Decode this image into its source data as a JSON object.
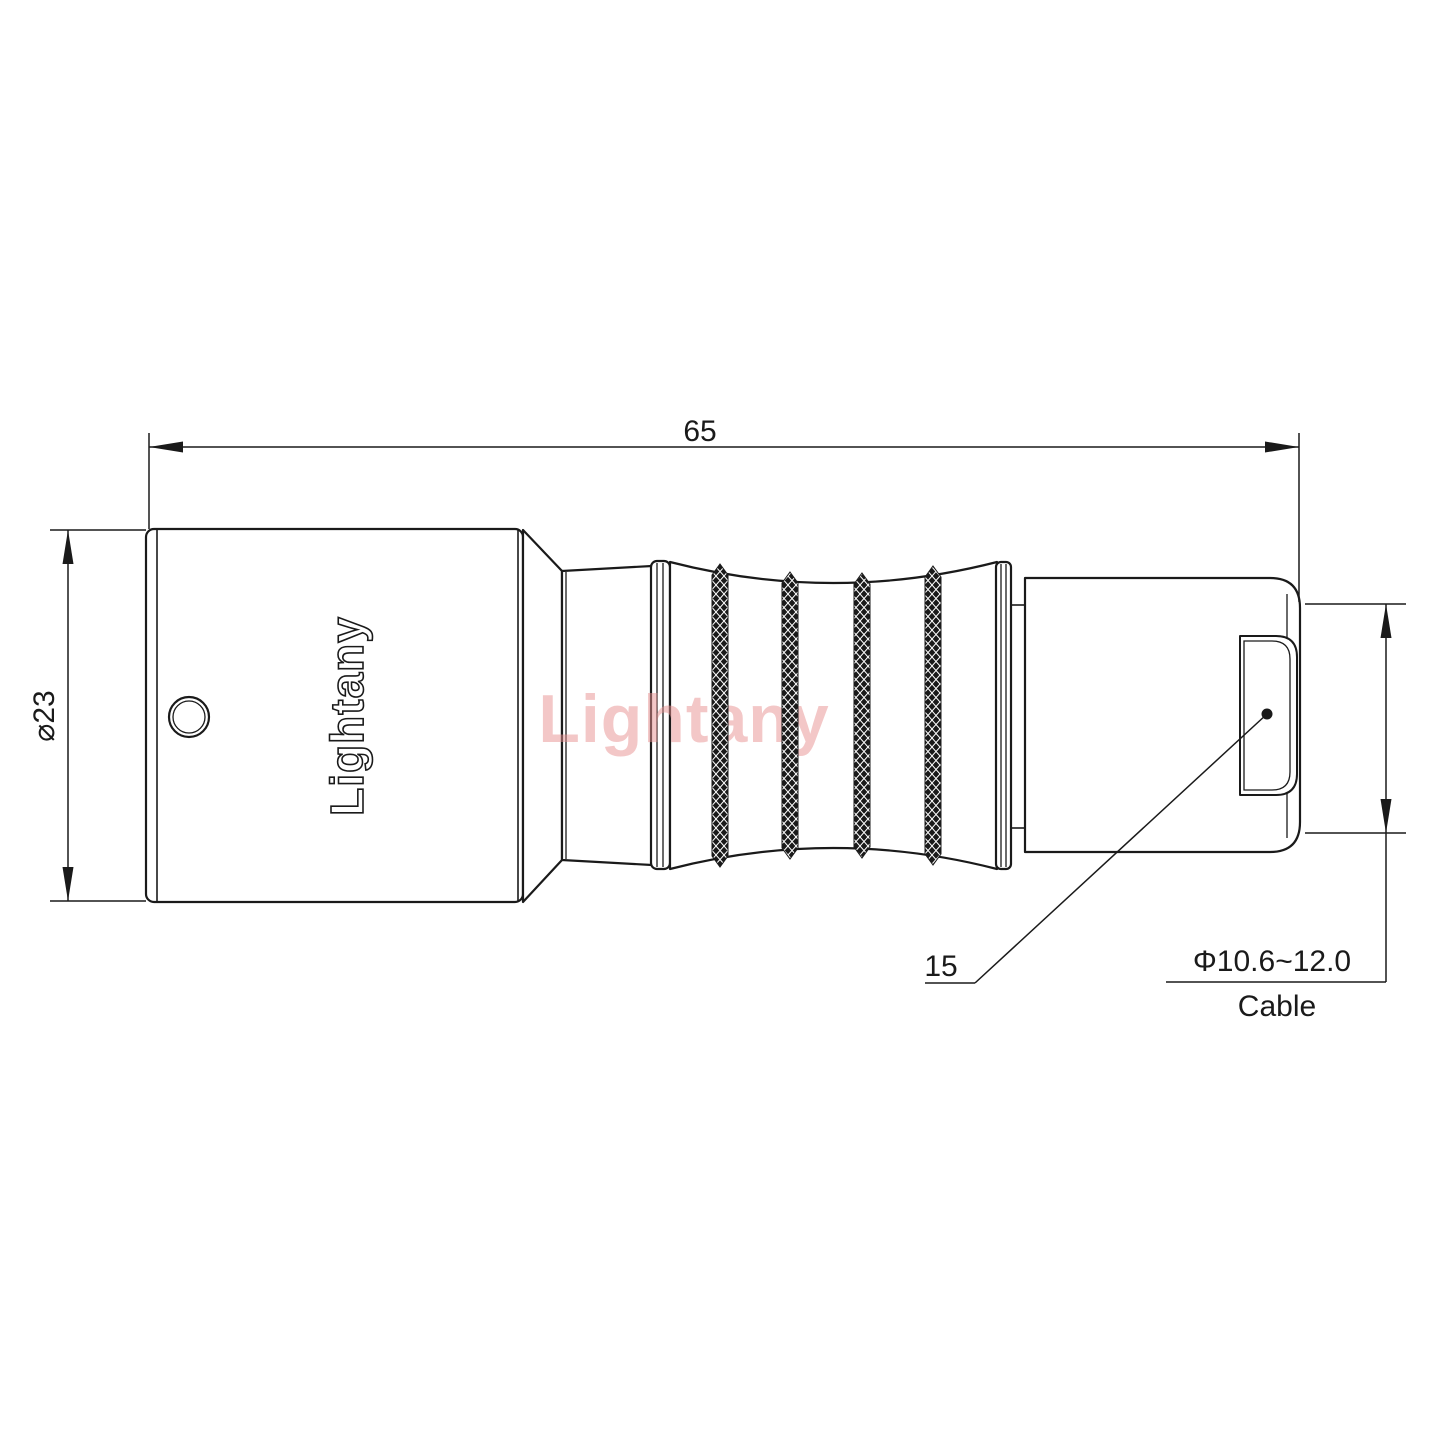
{
  "drawing": {
    "watermark_text": "Lightany",
    "engraving_text": "Lightany",
    "dimensions": {
      "overall_length": "65",
      "body_diameter": "⌀23",
      "boot_dimension": "15",
      "cable_diameter_range": "Φ10.6~12.0",
      "cable_label": "Cable"
    },
    "colors": {
      "line": "#1a1a1a",
      "watermark": "#e89090",
      "background": "#ffffff"
    }
  }
}
